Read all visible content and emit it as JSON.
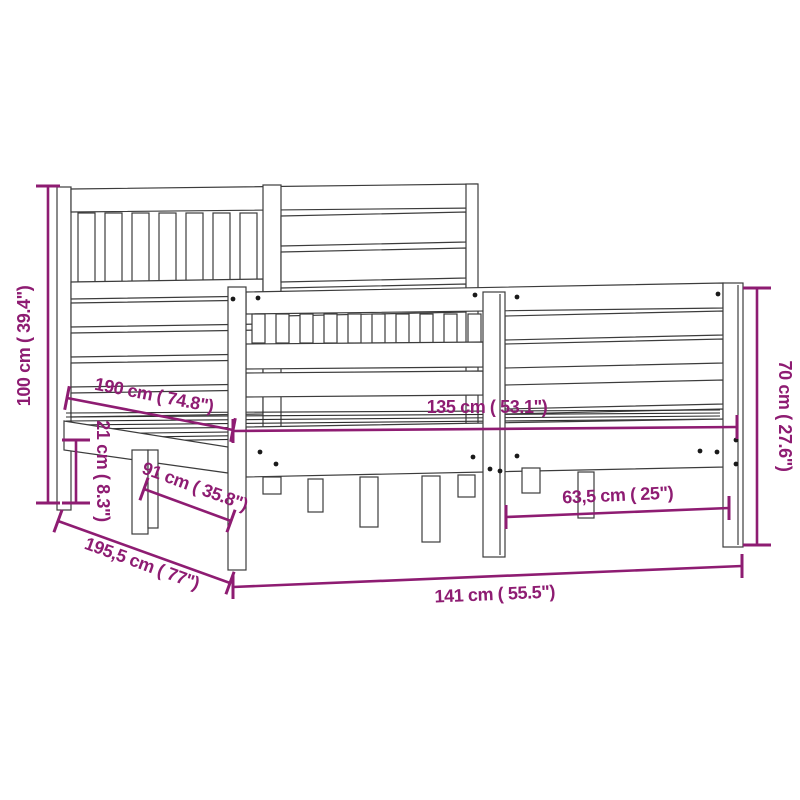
{
  "diagram": {
    "background_color": "#FFFFFF",
    "line_color": "#3C3C3C",
    "accent_color": "#8E1C72",
    "labels": {
      "headboard_height": "100 cm ( 39.4\")",
      "under_bed_clearance": "21 cm ( 8.3\")",
      "inner_length": "190 cm ( 74.8\")",
      "side_width": "91 cm ( 35.8\")",
      "total_length": "195,5 cm ( 77\")",
      "inner_width": "135 cm ( 53.1\")",
      "panel_width": "63,5 cm ( 25\")",
      "total_width": "141 cm ( 55.5\")",
      "footboard_height": "70 cm ( 27.6\")"
    }
  }
}
